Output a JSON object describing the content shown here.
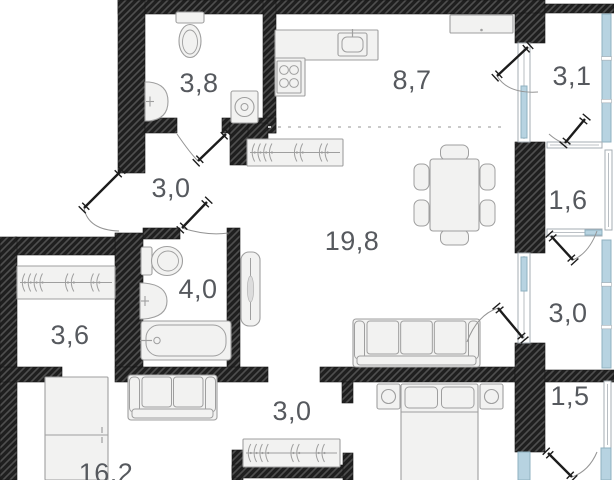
{
  "title": "apartment-floor-plan",
  "units": "m2",
  "colors": {
    "wallBase": "#1f1f1f",
    "wallHatch": "#4f4f4f",
    "furnFill": "#f2f2f1",
    "furnStroke": "#9f9f9f",
    "glass": "#b7d3e1",
    "glassFrame": "#8fb0c0",
    "frameFill": "#ffffff",
    "frameStroke": "#a6adb3",
    "label": "#56595e",
    "door": "#1c1c1c",
    "arc": "#949494",
    "dash": "#c9c9c9"
  },
  "plan": {
    "width": 614,
    "height": 480,
    "rooms": [
      {
        "id": "bathroom-small",
        "area": "3,8",
        "x": 199,
        "y": 83
      },
      {
        "id": "kitchen",
        "area": "8,7",
        "x": 412,
        "y": 80
      },
      {
        "id": "loggia-top",
        "area": "3,1",
        "x": 572,
        "y": 76
      },
      {
        "id": "hall-upper",
        "area": "3,0",
        "x": 171,
        "y": 188
      },
      {
        "id": "loggia-mid",
        "area": "1,6",
        "x": 568,
        "y": 200
      },
      {
        "id": "living-room",
        "area": "19,8",
        "x": 352,
        "y": 241
      },
      {
        "id": "bathroom",
        "area": "4,0",
        "x": 198,
        "y": 289
      },
      {
        "id": "loggia-lower",
        "area": "3,0",
        "x": 568,
        "y": 313
      },
      {
        "id": "closet",
        "area": "3,6",
        "x": 70,
        "y": 335
      },
      {
        "id": "loggia-bottom",
        "area": "1,5",
        "x": 570,
        "y": 396
      },
      {
        "id": "hall-lower",
        "area": "3,0",
        "x": 292,
        "y": 411
      },
      {
        "id": "bedroom-16",
        "area": "16,2",
        "x": 106,
        "y": 473
      }
    ],
    "walls": [
      {
        "id": "top-main",
        "x": 118,
        "y": 0,
        "w": 427,
        "h": 14
      },
      {
        "id": "top-right",
        "x": 545,
        "y": 4,
        "w": 69,
        "h": 9
      },
      {
        "id": "entry-col",
        "x": 118,
        "y": 0,
        "w": 27,
        "h": 173
      },
      {
        "id": "bath38-kitchen",
        "x": 263,
        "y": 0,
        "w": 13,
        "h": 133
      },
      {
        "id": "bath38-bottom-l",
        "x": 145,
        "y": 118,
        "w": 32,
        "h": 15
      },
      {
        "id": "bath38-bottom-r",
        "x": 222,
        "y": 118,
        "w": 54,
        "h": 15
      },
      {
        "id": "hall-living-a",
        "x": 230,
        "y": 123,
        "w": 38,
        "h": 17
      },
      {
        "id": "hall-living-b",
        "x": 230,
        "y": 123,
        "w": 18,
        "h": 42
      },
      {
        "id": "bath40-top",
        "x": 143,
        "y": 228,
        "w": 37,
        "h": 11
      },
      {
        "id": "bath40-right",
        "x": 227,
        "y": 228,
        "w": 13,
        "h": 144
      },
      {
        "id": "closet-col",
        "x": 115,
        "y": 233,
        "w": 28,
        "h": 134
      },
      {
        "id": "closet-top",
        "x": 15,
        "y": 237,
        "w": 100,
        "h": 18
      },
      {
        "id": "left-wall",
        "x": 0,
        "y": 237,
        "w": 17,
        "h": 243
      },
      {
        "id": "room16-top",
        "x": 0,
        "y": 367,
        "w": 62,
        "h": 15
      },
      {
        "id": "corridor-bottom",
        "x": 115,
        "y": 367,
        "w": 153,
        "h": 15
      },
      {
        "id": "living-bottom",
        "x": 320,
        "y": 367,
        "w": 195,
        "h": 15
      },
      {
        "id": "hall2-stub-a",
        "x": 342,
        "y": 382,
        "w": 11,
        "h": 21
      },
      {
        "id": "hall2-left",
        "x": 232,
        "y": 450,
        "w": 11,
        "h": 30
      },
      {
        "id": "hall2-bottom",
        "x": 232,
        "y": 465,
        "w": 118,
        "h": 13
      },
      {
        "id": "hall2-stub-b",
        "x": 343,
        "y": 453,
        "w": 10,
        "h": 27
      },
      {
        "id": "balc-col-a",
        "x": 515,
        "y": 13,
        "w": 30,
        "h": 30
      },
      {
        "id": "balc-col-b",
        "x": 515,
        "y": 142,
        "w": 30,
        "h": 111
      },
      {
        "id": "balc-col-c",
        "x": 515,
        "y": 343,
        "w": 30,
        "h": 109
      },
      {
        "id": "balc-15-top",
        "x": 545,
        "y": 370,
        "w": 69,
        "h": 12
      }
    ],
    "divider": {
      "x1": 268,
      "y1": 127,
      "x2": 508,
      "y2": 127
    },
    "windows": [
      {
        "id": "glz-31-right",
        "t": "blue",
        "x": 602,
        "y": 14,
        "w": 9,
        "h": 128
      },
      {
        "id": "frame-31-part",
        "t": "frame",
        "x": 518,
        "y": 43,
        "w": 12,
        "h": 99
      },
      {
        "id": "glz-31-part",
        "t": "blue",
        "x": 521,
        "y": 86,
        "w": 6,
        "h": 52
      },
      {
        "id": "frame-16-right",
        "t": "frame",
        "x": 605,
        "y": 150,
        "w": 7,
        "h": 80
      },
      {
        "id": "sill-31-16",
        "t": "frame",
        "x": 547,
        "y": 142,
        "w": 55,
        "h": 6
      },
      {
        "id": "sill-16-30",
        "t": "frame",
        "x": 547,
        "y": 229,
        "w": 55,
        "h": 7
      },
      {
        "id": "glz-16-30",
        "t": "blue",
        "x": 585,
        "y": 230,
        "w": 17,
        "h": 5
      },
      {
        "id": "glz-30-right",
        "t": "blue",
        "x": 602,
        "y": 240,
        "w": 9,
        "h": 128
      },
      {
        "id": "frame-30-part",
        "t": "frame",
        "x": 518,
        "y": 253,
        "w": 12,
        "h": 90
      },
      {
        "id": "glz-30-part",
        "t": "blue",
        "x": 521,
        "y": 257,
        "w": 6,
        "h": 34
      },
      {
        "id": "frame-15-right",
        "t": "frame",
        "x": 604,
        "y": 381,
        "w": 7,
        "h": 67
      },
      {
        "id": "glz-15-part",
        "t": "blue",
        "x": 518,
        "y": 452,
        "w": 12,
        "h": 28
      },
      {
        "id": "glz-br",
        "t": "blue",
        "x": 601,
        "y": 448,
        "w": 10,
        "h": 32
      }
    ],
    "doors": [
      {
        "id": "entrance",
        "leaf": [
          120,
          172,
          84,
          208
        ],
        "arc": [
          119,
          231
        ],
        "ctrl": [
          88,
          230
        ]
      },
      {
        "id": "bath-small",
        "leaf": [
          226,
          134,
          198,
          161
        ],
        "arc": [
          177,
          134
        ],
        "ctrl": [
          190,
          153
        ]
      },
      {
        "id": "bathroom",
        "leaf": [
          207,
          202,
          182,
          228
        ],
        "arc": [
          228,
          233
        ],
        "ctrl": [
          207,
          236
        ]
      },
      {
        "id": "loggia-top",
        "leaf": [
          528,
          47,
          497,
          76
        ],
        "arc": [
          538,
          92
        ],
        "ctrl": [
          508,
          94
        ]
      },
      {
        "id": "loggia-31-16",
        "leaf": [
          585,
          119,
          565,
          143
        ],
        "arc": [
          549,
          134
        ],
        "ctrl": [
          558,
          142
        ]
      },
      {
        "id": "loggia-16-30",
        "leaf": [
          551,
          236,
          573,
          260
        ],
        "arc": [
          597,
          231
        ],
        "ctrl": [
          589,
          253
        ]
      },
      {
        "id": "loggia-30",
        "leaf": [
          523,
          338,
          498,
          308
        ],
        "arc": [
          467,
          342
        ],
        "ctrl": [
          477,
          315
        ]
      },
      {
        "id": "loggia-15",
        "leaf": [
          548,
          453,
          572,
          477
        ],
        "arc": [
          597,
          452
        ],
        "ctrl": [
          589,
          471
        ]
      }
    ],
    "furniture": [
      {
        "id": "toilet-top",
        "t": "toiletV",
        "x": 176,
        "y": 12,
        "w": 28,
        "h": 46
      },
      {
        "id": "sink-top",
        "t": "sinkR",
        "x": 145,
        "y": 82,
        "w": 23,
        "h": 39
      },
      {
        "id": "washing-machine",
        "t": "washer",
        "x": 231,
        "y": 91,
        "w": 27,
        "h": 32
      },
      {
        "id": "counter-top",
        "t": "rect",
        "x": 275,
        "y": 30,
        "w": 103,
        "h": 30
      },
      {
        "id": "counter-side",
        "t": "rect",
        "x": 275,
        "y": 58,
        "w": 30,
        "h": 38
      },
      {
        "id": "kitchen-sink",
        "t": "ksink",
        "x": 338,
        "y": 33,
        "w": 29,
        "h": 23
      },
      {
        "id": "stove",
        "t": "stove",
        "x": 277,
        "y": 61,
        "w": 24,
        "h": 32
      },
      {
        "id": "cabinet-top",
        "t": "cabinet",
        "x": 450,
        "y": 15,
        "w": 63,
        "h": 18
      },
      {
        "id": "wardrobe-hall-top",
        "t": "robe",
        "x": 247,
        "y": 139,
        "w": 96,
        "h": 27
      },
      {
        "id": "dining-set",
        "t": "dining",
        "x": 413,
        "y": 144,
        "w": 83,
        "h": 102
      },
      {
        "id": "sofa",
        "t": "sofa3",
        "x": 353,
        "y": 319,
        "w": 127,
        "h": 48
      },
      {
        "id": "mirror",
        "t": "mirror",
        "x": 241,
        "y": 252,
        "w": 19,
        "h": 74
      },
      {
        "id": "toilet-side",
        "t": "toiletH",
        "x": 141,
        "y": 246,
        "w": 42,
        "h": 30
      },
      {
        "id": "sink-bath",
        "t": "sinkR",
        "x": 140,
        "y": 283,
        "w": 27,
        "h": 36
      },
      {
        "id": "bathtub",
        "t": "tub",
        "x": 141,
        "y": 321,
        "w": 90,
        "h": 39
      },
      {
        "id": "wardrobe-closet",
        "t": "robe",
        "x": 17,
        "y": 266,
        "w": 98,
        "h": 33
      },
      {
        "id": "wardrobe-room16",
        "t": "wardrobe2",
        "x": 45,
        "y": 377,
        "w": 63,
        "h": 103
      },
      {
        "id": "loveseat",
        "t": "sofa2",
        "x": 128,
        "y": 375,
        "w": 89,
        "h": 45
      },
      {
        "id": "wardrobe-hall-low",
        "t": "robe",
        "x": 243,
        "y": 439,
        "w": 97,
        "h": 28
      },
      {
        "id": "nightstand-left",
        "t": "nightstand",
        "x": 377,
        "y": 384,
        "w": 23,
        "h": 25
      },
      {
        "id": "nightstand-right",
        "t": "nightstand",
        "x": 480,
        "y": 384,
        "w": 23,
        "h": 25
      },
      {
        "id": "bed",
        "t": "bed",
        "x": 401,
        "y": 384,
        "w": 77,
        "h": 96
      }
    ]
  }
}
